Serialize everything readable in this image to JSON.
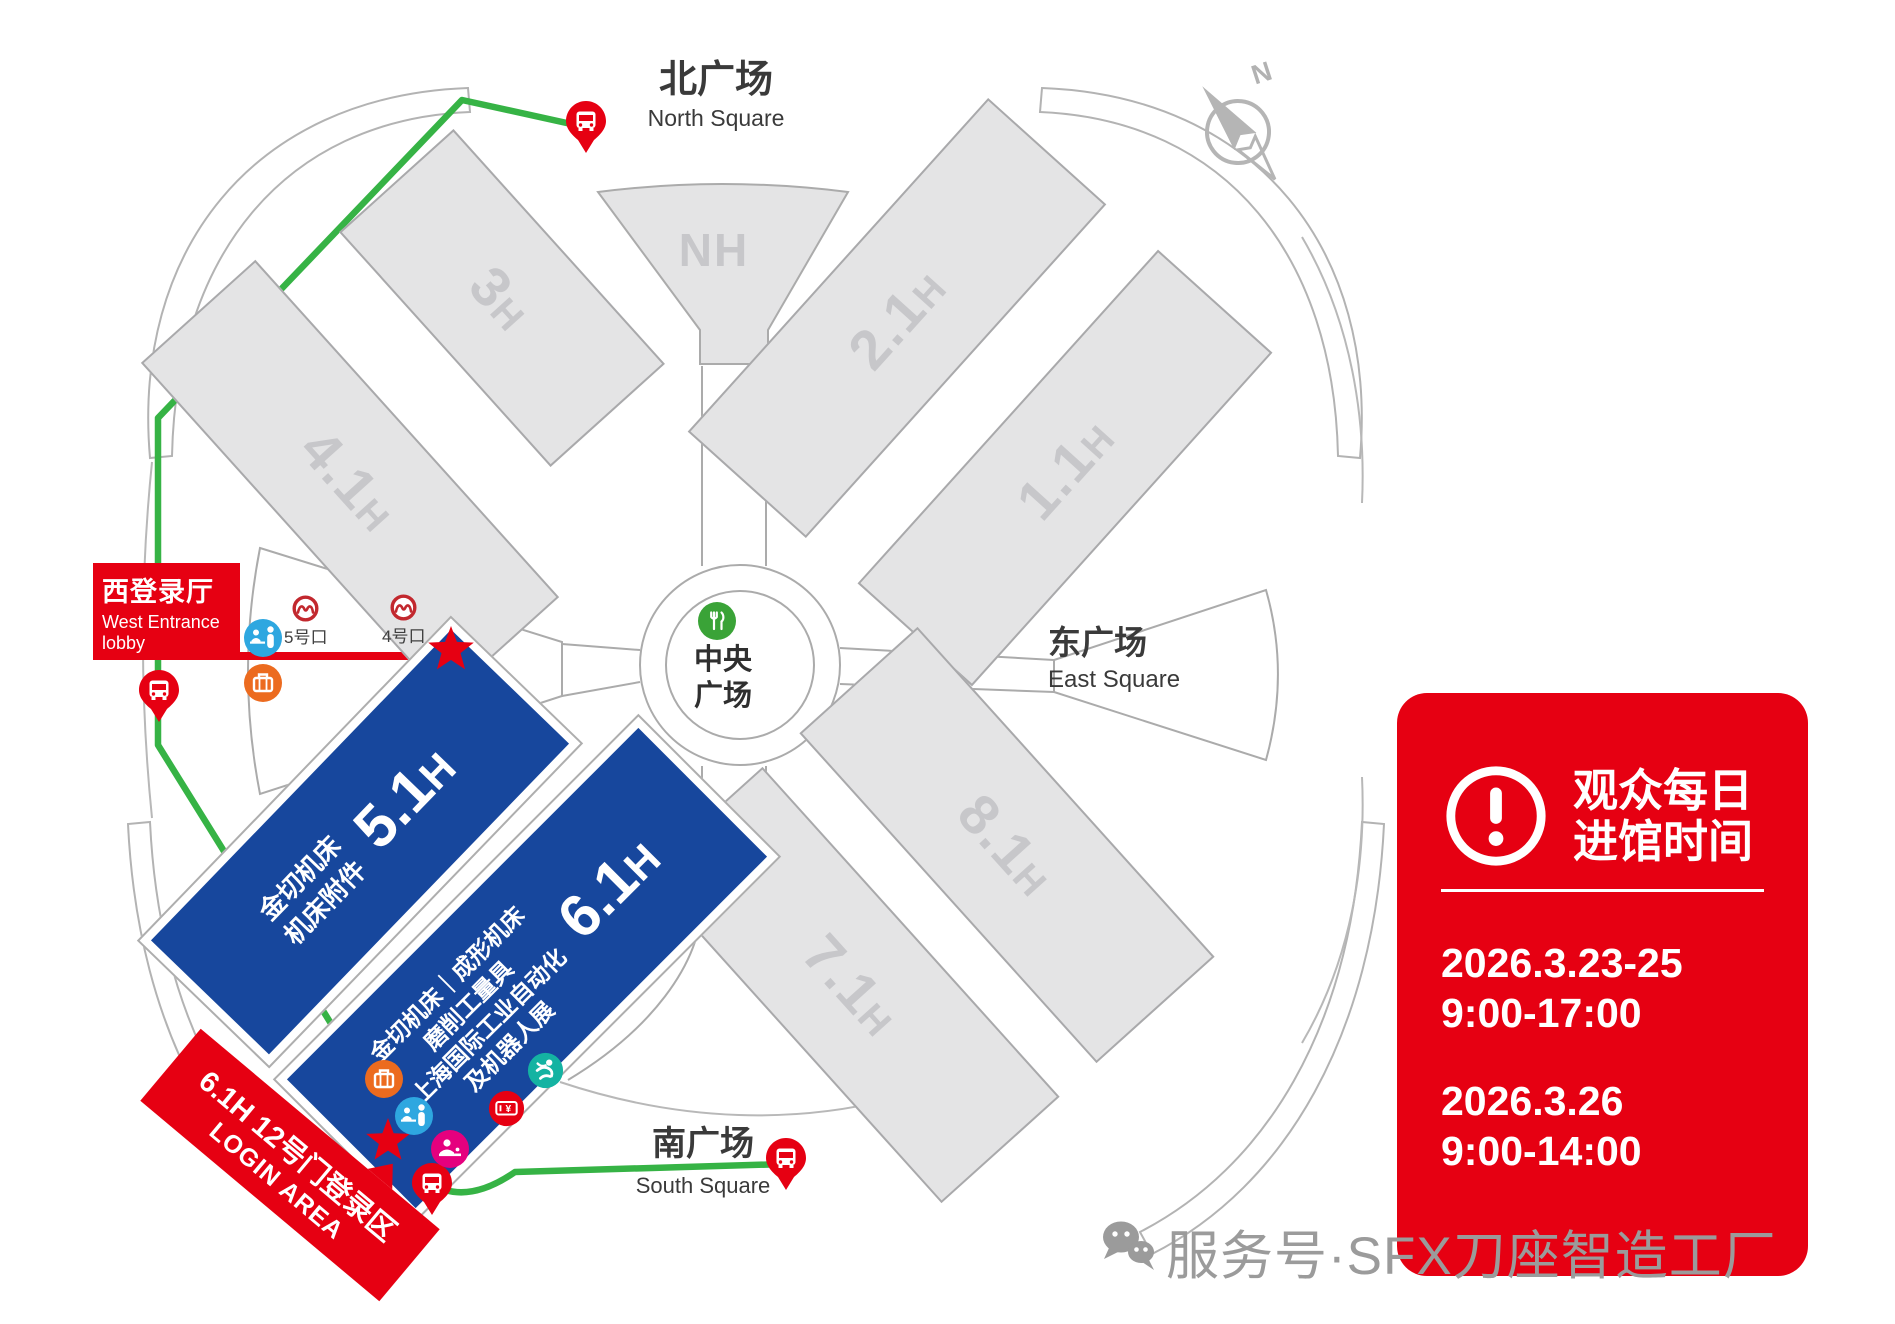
{
  "squares": {
    "north": {
      "zh": "北广场",
      "en": "North Square"
    },
    "south": {
      "zh": "南广场",
      "en": "South Square"
    },
    "east": {
      "zh": "东广场",
      "en": "East Square"
    },
    "central": {
      "line1": "中央",
      "line2": "广场"
    }
  },
  "halls": {
    "h41": {
      "num": "4.1",
      "suffix": "H"
    },
    "h3": {
      "num": "3",
      "suffix": "H"
    },
    "nh": {
      "label": "NH"
    },
    "h21": {
      "num": "2.1",
      "suffix": "H"
    },
    "h11": {
      "num": "1.1",
      "suffix": "H"
    },
    "h81": {
      "num": "8.1",
      "suffix": "H"
    },
    "h71": {
      "num": "7.1",
      "suffix": "H"
    },
    "h51": {
      "num": "5.1",
      "suffix": "H",
      "lines": [
        "金切机床",
        "机床附件"
      ]
    },
    "h61": {
      "num": "6.1",
      "suffix": "H",
      "lines": [
        "金切机床｜成形机床",
        "磨削工量具",
        "上海国际工业自动化",
        "及机器人展"
      ]
    }
  },
  "west_entrance": {
    "zh": "西登录厅",
    "en1": "West Entrance",
    "en2": "lobby"
  },
  "gates": {
    "gate5": "5号口",
    "gate4": "4号口"
  },
  "login_banner": {
    "zh": "6.1H 12号门登录区",
    "en": "LOGIN AREA"
  },
  "info_card": {
    "title1": "观众每日",
    "title2": "进馆时间",
    "schedule": [
      {
        "dates": "2026.3.23-25",
        "hours": "9:00-17:00"
      },
      {
        "dates": "2026.3.26",
        "hours": "9:00-14:00"
      }
    ]
  },
  "watermark": {
    "text": "服务号·SFX刀座智造工厂"
  },
  "compass": {
    "label": "N"
  },
  "colors": {
    "accent_red": "#e60012",
    "hall_blue": "#17479d",
    "route_green": "#36b345",
    "hall_gray": "#e4e4e5",
    "hall_label_gray": "#c7c7ca",
    "metro_red": "#c2282e",
    "luggage_orange": "#ec6b1f",
    "registration_azure": "#2ea7e0",
    "badge_magenta": "#e5007e",
    "person_teal": "#14b3a2",
    "food_green": "#3aa337",
    "watermark_gray": "#9b9b9b"
  }
}
